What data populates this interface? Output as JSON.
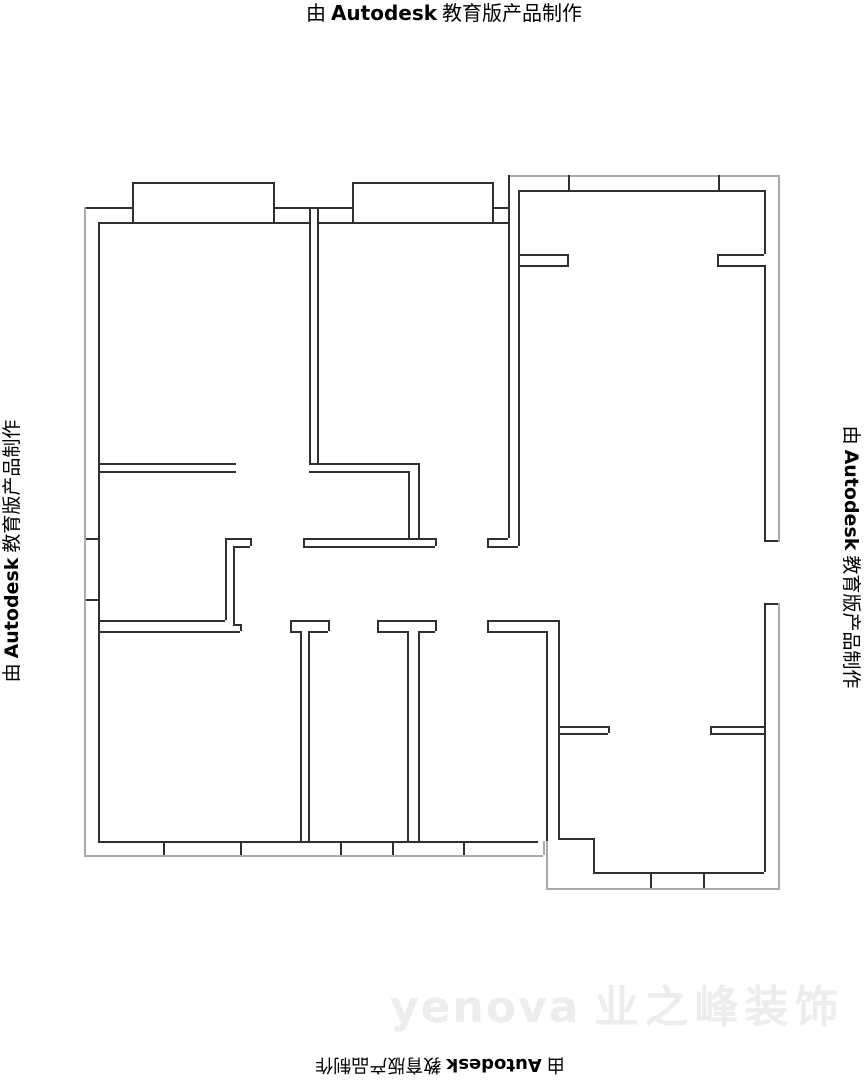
{
  "page": {
    "width": 864,
    "height": 1080,
    "background": "#ffffff"
  },
  "watermark": {
    "pre": "由",
    "brand": "Autodesk",
    "post": "教育版产品制作",
    "color": "#000000"
  },
  "ghost_logo": {
    "latin": "yenova",
    "cjk": "业之峰装饰",
    "color": "#ededed"
  },
  "colors": {
    "w": "#2f2f2f",
    "o": "#a9a9a9"
  },
  "floorplan": {
    "lines": [
      [
        84,
        207,
        48,
        2,
        "w"
      ],
      [
        273,
        207,
        79,
        2,
        "w"
      ],
      [
        492,
        207,
        16,
        2,
        "w"
      ],
      [
        132,
        182,
        141,
        2,
        "w"
      ],
      [
        352,
        182,
        140,
        2,
        "w"
      ],
      [
        98,
        222,
        211,
        2,
        "w"
      ],
      [
        317,
        222,
        191,
        2,
        "w"
      ],
      [
        508,
        175,
        272,
        2,
        "o"
      ],
      [
        518,
        190,
        246,
        2,
        "w"
      ],
      [
        518,
        254,
        49,
        2,
        "w"
      ],
      [
        518,
        265,
        49,
        2,
        "w"
      ],
      [
        717,
        254,
        47,
        2,
        "w"
      ],
      [
        717,
        265,
        47,
        2,
        "w"
      ],
      [
        98,
        463,
        138,
        2,
        "w"
      ],
      [
        98,
        471,
        138,
        2,
        "w"
      ],
      [
        309,
        463,
        109,
        2,
        "w"
      ],
      [
        309,
        471,
        99,
        2,
        "w"
      ],
      [
        225,
        538,
        25,
        2,
        "w"
      ],
      [
        233,
        546,
        17,
        2,
        "w"
      ],
      [
        303,
        538,
        132,
        2,
        "w"
      ],
      [
        303,
        546,
        132,
        2,
        "w"
      ],
      [
        487,
        538,
        21,
        2,
        "w"
      ],
      [
        487,
        546,
        31,
        2,
        "w"
      ],
      [
        98,
        620,
        127,
        2,
        "w"
      ],
      [
        98,
        631,
        142,
        2,
        "w"
      ],
      [
        233,
        624,
        7,
        2,
        "w"
      ],
      [
        290,
        620,
        38,
        2,
        "w"
      ],
      [
        290,
        631,
        10,
        2,
        "w"
      ],
      [
        308,
        631,
        20,
        2,
        "w"
      ],
      [
        377,
        620,
        58,
        2,
        "w"
      ],
      [
        377,
        631,
        30,
        2,
        "w"
      ],
      [
        418,
        631,
        17,
        2,
        "w"
      ],
      [
        487,
        620,
        71,
        2,
        "w"
      ],
      [
        487,
        631,
        59,
        2,
        "w"
      ],
      [
        558,
        726,
        50,
        2,
        "w"
      ],
      [
        558,
        733,
        50,
        2,
        "w"
      ],
      [
        710,
        726,
        54,
        2,
        "w"
      ],
      [
        710,
        733,
        54,
        2,
        "w"
      ],
      [
        558,
        838,
        35,
        2,
        "w"
      ],
      [
        593,
        872,
        171,
        2,
        "w"
      ],
      [
        98,
        841,
        440,
        2,
        "w"
      ],
      [
        84,
        855,
        459,
        2,
        "o"
      ],
      [
        546,
        888,
        234,
        2,
        "o"
      ],
      [
        764,
        540,
        14,
        2,
        "w"
      ],
      [
        764,
        603,
        14,
        2,
        "w"
      ],
      [
        84,
        538,
        14,
        2,
        "w"
      ],
      [
        84,
        599,
        14,
        2,
        "w"
      ],
      [
        84,
        207,
        2,
        650,
        "o"
      ],
      [
        98,
        222,
        2,
        619,
        "w"
      ],
      [
        132,
        182,
        2,
        40,
        "w"
      ],
      [
        273,
        182,
        2,
        40,
        "w"
      ],
      [
        352,
        182,
        2,
        40,
        "w"
      ],
      [
        492,
        182,
        2,
        40,
        "w"
      ],
      [
        309,
        207,
        2,
        256,
        "w"
      ],
      [
        317,
        207,
        2,
        256,
        "w"
      ],
      [
        408,
        471,
        2,
        67,
        "w"
      ],
      [
        418,
        463,
        2,
        75,
        "w"
      ],
      [
        508,
        175,
        2,
        363,
        "w"
      ],
      [
        518,
        190,
        2,
        356,
        "w"
      ],
      [
        568,
        175,
        2,
        15,
        "w"
      ],
      [
        718,
        175,
        2,
        15,
        "w"
      ],
      [
        778,
        175,
        2,
        367,
        "o"
      ],
      [
        764,
        190,
        2,
        64,
        "w"
      ],
      [
        567,
        254,
        2,
        13,
        "w"
      ],
      [
        717,
        254,
        2,
        13,
        "w"
      ],
      [
        764,
        265,
        2,
        275,
        "w"
      ],
      [
        225,
        538,
        2,
        82,
        "w"
      ],
      [
        233,
        546,
        2,
        78,
        "w"
      ],
      [
        250,
        538,
        2,
        8,
        "w"
      ],
      [
        303,
        538,
        2,
        8,
        "w"
      ],
      [
        435,
        538,
        2,
        8,
        "w"
      ],
      [
        487,
        538,
        2,
        8,
        "w"
      ],
      [
        240,
        624,
        2,
        7,
        "w"
      ],
      [
        290,
        620,
        2,
        11,
        "w"
      ],
      [
        328,
        620,
        2,
        11,
        "w"
      ],
      [
        300,
        631,
        2,
        210,
        "w"
      ],
      [
        308,
        631,
        2,
        210,
        "w"
      ],
      [
        377,
        620,
        2,
        11,
        "w"
      ],
      [
        435,
        620,
        2,
        11,
        "w"
      ],
      [
        407,
        631,
        2,
        210,
        "w"
      ],
      [
        418,
        631,
        2,
        210,
        "w"
      ],
      [
        487,
        620,
        2,
        11,
        "w"
      ],
      [
        546,
        631,
        2,
        210,
        "w"
      ],
      [
        546,
        841,
        2,
        47,
        "o"
      ],
      [
        558,
        620,
        2,
        218,
        "w"
      ],
      [
        593,
        838,
        2,
        34,
        "w"
      ],
      [
        608,
        726,
        2,
        7,
        "w"
      ],
      [
        710,
        726,
        2,
        7,
        "w"
      ],
      [
        764,
        603,
        2,
        269,
        "w"
      ],
      [
        778,
        603,
        2,
        285,
        "o"
      ],
      [
        543,
        841,
        2,
        14,
        "o"
      ],
      [
        163,
        841,
        2,
        14,
        "w"
      ],
      [
        240,
        841,
        2,
        14,
        "w"
      ],
      [
        340,
        841,
        2,
        14,
        "w"
      ],
      [
        392,
        841,
        2,
        14,
        "w"
      ],
      [
        463,
        841,
        2,
        14,
        "w"
      ],
      [
        650,
        872,
        2,
        16,
        "w"
      ],
      [
        703,
        872,
        2,
        16,
        "w"
      ]
    ]
  }
}
